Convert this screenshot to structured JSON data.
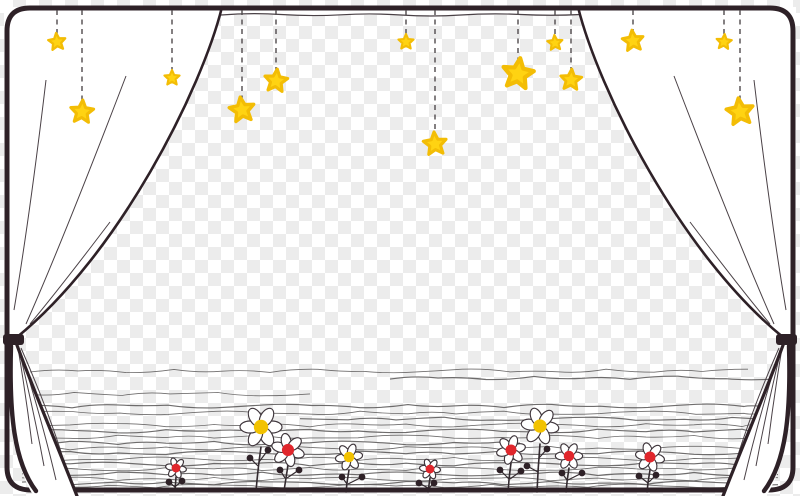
{
  "illustration": {
    "type": "clipart-curtain-frame-with-stars-and-flowers",
    "canvas": {
      "width": 800,
      "height": 496
    },
    "background": {
      "style": "transparency-checkerboard",
      "cell_px": 13,
      "color_light": "#ffffff",
      "color_gray": "#ececec"
    },
    "palette": {
      "ink": "#2e2127",
      "fold_line": "#4a4146",
      "string": "#4f4a4c",
      "squiggle": "#5f5d5d",
      "star_yellow": "#ffd312",
      "star_edge": "#f3bd05",
      "flower_yellow": "#f2c200",
      "flower_red": "#e0262c",
      "curtain_white": "#ffffff",
      "stem": "#332a2f"
    },
    "frame": {
      "path": "M30,8 H770 Q793,8 793,31 V467 Q793,490 769,490 H31 Q7,490 7,467 V31 Q7,8 30,8",
      "stroke_width": 5
    },
    "valance": {
      "strip": {
        "x": 220,
        "y": 9,
        "w": 360,
        "h": 6
      },
      "line_path": "M221,15 Q251,12.5 281,14.5 Q311,16.5 341,14.8 Q371,13 401,15 Q431,17 461,15 Q491,13 521,14.5 Q551,16 581,14.5"
    },
    "curtains": {
      "left": {
        "fill_path": "M222,7 H4 V338 H16 C 120,254 202,88 222,7 Z",
        "edge_path": "M222,7 C 202,88 120,254 16,338",
        "fold_paths": [
          "M46,80 Q30,215 14,310",
          "M126,76 Q64,238 26,324",
          "M110,222 Q60,288 30,324"
        ]
      },
      "right": {
        "fill_path": "M578,7 H796 V338 H784 C 680,254 598,88 578,7 Z",
        "edge_path": "M578,7 C 598,88 680,254 784,338",
        "fold_paths": [
          "M754,80 Q770,215 786,310",
          "M674,76 Q736,238 774,324",
          "M690,222 Q740,288 770,324"
        ]
      },
      "left_flare": {
        "fill_path": "M13,336 C 30,382 56,442 78,496 L34,496 C 17,472 10,428 10,378 L11,344 Z",
        "edge_outer_path": "M14,337 C 30,382 56,442 77,496",
        "edge_inner_path": "M11,346 C 9,414 14,462 36,491",
        "fold_paths": [
          "M18,348 Q26,396 32,444",
          "M19,350 Q34,412 44,466",
          "M20,350 Q42,420 56,480",
          "M21,348 Q50,414 66,468"
        ]
      },
      "right_flare": {
        "fill_path": "M787,336 C 770,382 744,442 722,496 L766,496 C 783,472 790,428 790,378 L789,344 Z",
        "edge_outer_path": "M786,337 C 770,382 744,442 723,496",
        "edge_inner_path": "M789,346 C 791,414 786,462 764,491",
        "fold_paths": [
          "M782,348 Q774,396 768,444",
          "M781,350 Q766,412 756,466",
          "M780,350 Q758,420 744,480",
          "M779,348 Q750,414 734,468"
        ]
      }
    },
    "tiebacks": [
      {
        "x": 3,
        "y": 334,
        "w": 21,
        "h": 11
      },
      {
        "x": 776,
        "y": 334,
        "w": 21,
        "h": 11
      }
    ],
    "stars": [
      {
        "cx": 57,
        "cy": 42,
        "r": 9,
        "rot": -6,
        "string_to": 34
      },
      {
        "cx": 82,
        "cy": 112,
        "r": 12,
        "rot": 4,
        "string_to": 101
      },
      {
        "cx": 172,
        "cy": 78,
        "r": 8,
        "rot": 0,
        "string_to": 71
      },
      {
        "cx": 242,
        "cy": 110,
        "r": 13,
        "rot": -8,
        "string_to": 98
      },
      {
        "cx": 276,
        "cy": 81,
        "r": 12,
        "rot": 6,
        "string_to": 70
      },
      {
        "cx": 406,
        "cy": 42,
        "r": 8,
        "rot": 0,
        "string_to": 35
      },
      {
        "cx": 435,
        "cy": 144,
        "r": 12,
        "rot": -5,
        "string_to": 133
      },
      {
        "cx": 518,
        "cy": 74,
        "r": 16,
        "rot": 8,
        "string_to": 59
      },
      {
        "cx": 555,
        "cy": 43,
        "r": 8,
        "rot": -4,
        "string_to": 36
      },
      {
        "cx": 571,
        "cy": 80,
        "r": 11,
        "rot": 4,
        "string_to": 70
      },
      {
        "cx": 633,
        "cy": 41,
        "r": 11,
        "rot": -6,
        "string_to": 31
      },
      {
        "cx": 724,
        "cy": 42,
        "r": 8,
        "rot": 5,
        "string_to": 35
      },
      {
        "cx": 740,
        "cy": 112,
        "r": 14,
        "rot": -7,
        "string_to": 99
      }
    ],
    "string_top_y": 10,
    "ground_lines": [
      {
        "y": 371,
        "x1": 30,
        "x2": 748,
        "seed": 1
      },
      {
        "y": 378,
        "x1": 390,
        "x2": 770,
        "seed": 2
      },
      {
        "y": 394,
        "x1": 26,
        "x2": 310,
        "seed": 3
      },
      {
        "y": 406,
        "x1": 24,
        "x2": 776,
        "seed": 4
      },
      {
        "y": 413,
        "x1": 24,
        "x2": 776,
        "seed": 5
      },
      {
        "y": 419,
        "x1": 300,
        "x2": 778,
        "seed": 6
      },
      {
        "y": 425,
        "x1": 22,
        "x2": 778,
        "seed": 7
      },
      {
        "y": 431,
        "x1": 22,
        "x2": 778,
        "seed": 8
      },
      {
        "y": 437,
        "x1": 22,
        "x2": 778,
        "seed": 9
      },
      {
        "y": 443,
        "x1": 22,
        "x2": 520,
        "seed": 10
      },
      {
        "y": 448,
        "x1": 22,
        "x2": 778,
        "seed": 11
      },
      {
        "y": 453,
        "x1": 22,
        "x2": 778,
        "seed": 12
      },
      {
        "y": 459,
        "x1": 22,
        "x2": 778,
        "seed": 13
      },
      {
        "y": 464,
        "x1": 22,
        "x2": 778,
        "seed": 14
      },
      {
        "y": 469,
        "x1": 22,
        "x2": 778,
        "seed": 15
      },
      {
        "y": 474,
        "x1": 22,
        "x2": 778,
        "seed": 16
      },
      {
        "y": 479,
        "x1": 22,
        "x2": 778,
        "seed": 17
      },
      {
        "y": 483,
        "x1": 22,
        "x2": 778,
        "seed": 18
      },
      {
        "y": 486,
        "x1": 60,
        "x2": 740,
        "seed": 19
      }
    ],
    "flowers": [
      {
        "cx": 176,
        "cy": 468,
        "r": 10,
        "center": "red",
        "rot": 10,
        "stem": "M175,491 L176,477",
        "buds": [
          [
            169,
            482,
            175,
            487
          ],
          [
            182,
            481,
            176,
            486
          ]
        ]
      },
      {
        "cx": 261,
        "cy": 427,
        "r": 20,
        "center": "yellow",
        "rot": 0,
        "stem": "M256,491 Q258,468 261,447",
        "buds": [
          [
            250,
            458,
            258,
            466
          ],
          [
            268,
            450,
            259,
            462
          ]
        ]
      },
      {
        "cx": 288,
        "cy": 450,
        "r": 16,
        "center": "red",
        "rot": 18,
        "stem": "M284,491 Q286,478 288,465",
        "buds": [
          [
            280,
            470,
            285,
            478
          ],
          [
            299,
            470,
            287,
            478
          ]
        ]
      },
      {
        "cx": 349,
        "cy": 457,
        "r": 13,
        "center": "yellow",
        "rot": -8,
        "stem": "M346,492 Q347,481 349,470",
        "buds": [
          [
            342,
            477,
            347,
            484
          ],
          [
            362,
            477,
            348,
            484
          ]
        ]
      },
      {
        "cx": 430,
        "cy": 469,
        "r": 10,
        "center": "red",
        "rot": 6,
        "stem": "M428,492 L430,478",
        "buds": [
          [
            419,
            483,
            428,
            488
          ],
          [
            434,
            483,
            429,
            488
          ]
        ]
      },
      {
        "cx": 511,
        "cy": 450,
        "r": 14,
        "center": "red",
        "rot": -14,
        "stem": "M508,492 Q509,477 511,463",
        "buds": [
          [
            500,
            470,
            509,
            479
          ],
          [
            521,
            471,
            510,
            479
          ]
        ]
      },
      {
        "cx": 540,
        "cy": 426,
        "r": 18,
        "center": "yellow",
        "rot": 8,
        "stem": "M537,492 Q538,468 540,444",
        "buds": [
          [
            547,
            449,
            539,
            458
          ],
          [
            527,
            466,
            538,
            472
          ]
        ]
      },
      {
        "cx": 569,
        "cy": 456,
        "r": 13,
        "center": "red",
        "rot": 0,
        "stem": "M566,492 Q567,480 569,468",
        "buds": [
          [
            562,
            473,
            567,
            480
          ],
          [
            582,
            473,
            568,
            480
          ]
        ]
      },
      {
        "cx": 650,
        "cy": 457,
        "r": 14,
        "center": "red",
        "rot": 12,
        "stem": "M647,492 Q648,481 650,470",
        "buds": [
          [
            639,
            476,
            648,
            483
          ],
          [
            656,
            475,
            649,
            482
          ]
        ]
      }
    ]
  }
}
